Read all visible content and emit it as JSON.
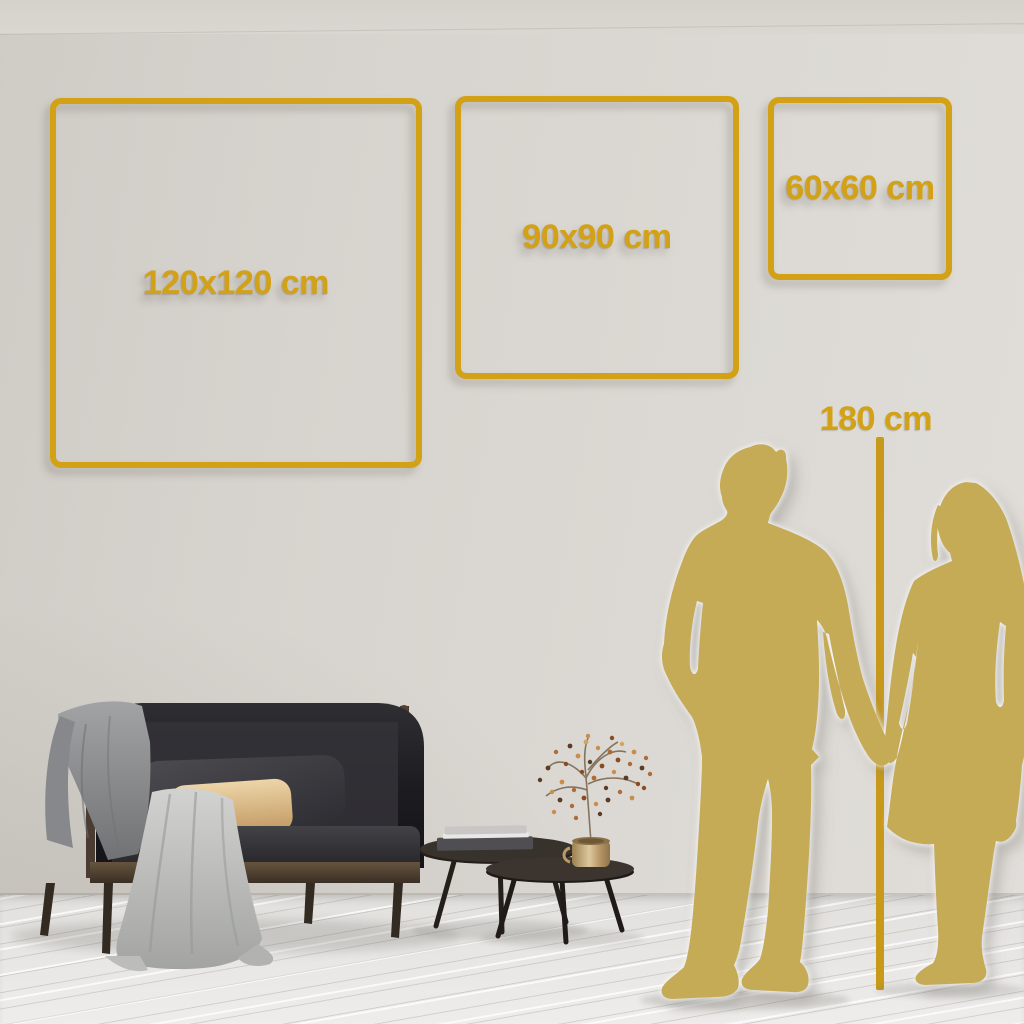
{
  "palette": {
    "accent_gold": "#d2a115",
    "line_gold": "#c9991a",
    "silhouette_gold": "#c6ab57",
    "wall": "#d9d5d0",
    "floor": "#eae8e5"
  },
  "size_boxes": [
    {
      "label": "120x120 cm"
    },
    {
      "label": "90x90 cm"
    },
    {
      "label": "60x60 cm"
    }
  ],
  "height_marker": {
    "label": "180 cm"
  },
  "scene": {
    "silhouettes": [
      "man-silhouette",
      "woman-silhouette"
    ],
    "furniture": [
      "sofa-with-blanket",
      "nesting-coffee-tables",
      "books",
      "gold-vase-with-dried-plant"
    ]
  }
}
